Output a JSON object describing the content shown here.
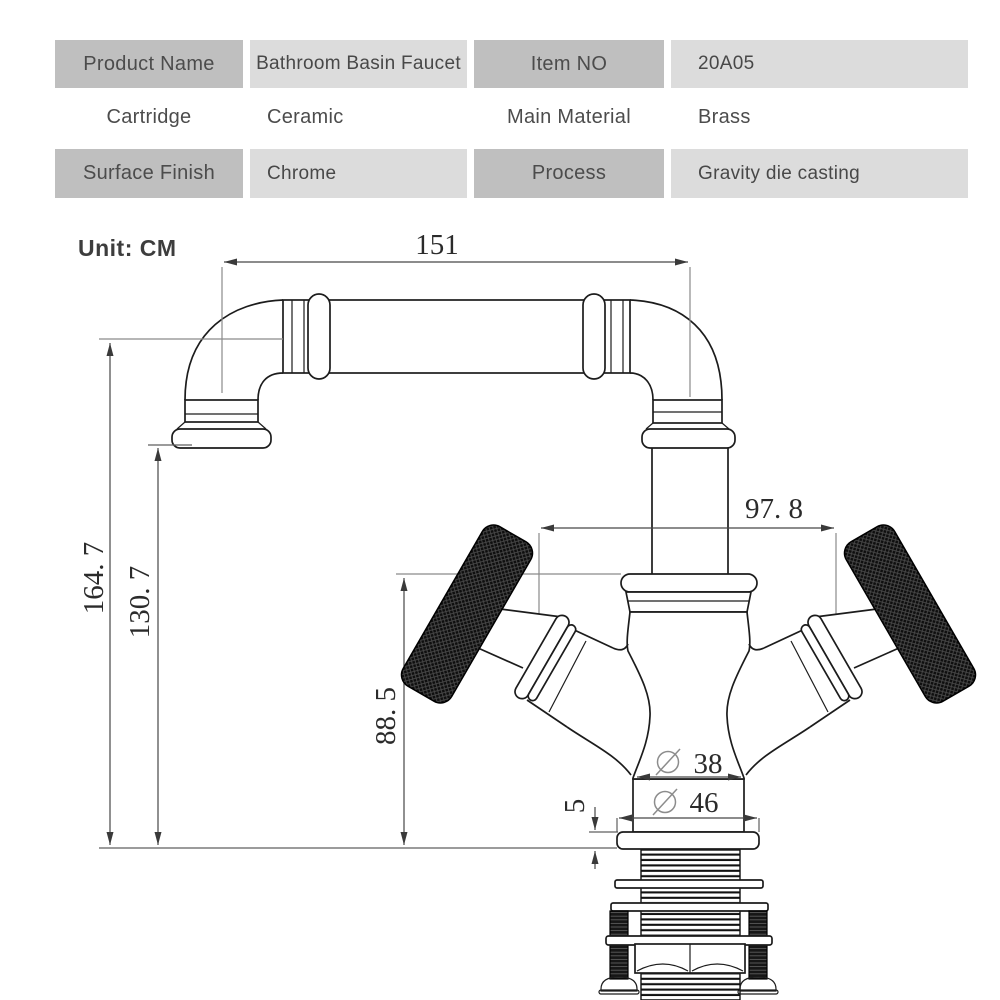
{
  "table": {
    "rows": [
      {
        "cells": [
          "Product Name",
          "Bathroom Basin Faucet",
          "Item NO",
          "20A05"
        ]
      },
      {
        "cells": [
          "Cartridge",
          "Ceramic",
          "Main Material",
          "Brass"
        ]
      },
      {
        "cells": [
          "Surface Finish",
          "Chrome",
          "Process",
          "Gravity die casting"
        ]
      }
    ]
  },
  "drawing": {
    "unit_label": "Unit: CM",
    "diameter_symbol": "⌀",
    "dimensions": {
      "spout_reach": "151",
      "overall_height": "164. 7",
      "spout_height": "130. 7",
      "handle_height": "88. 5",
      "handle_span": "97. 8",
      "body_diameter": "38",
      "base_diameter": "46",
      "deck_thickness": "5"
    }
  },
  "colors": {
    "header_cell": "#bfbfbf",
    "value_cell": "#dcdcdc",
    "table_text": "#4a4a4a",
    "drawing_line": "#1c1c1c",
    "dimension_line": "#474747",
    "extension_line": "#8a8a8a"
  }
}
